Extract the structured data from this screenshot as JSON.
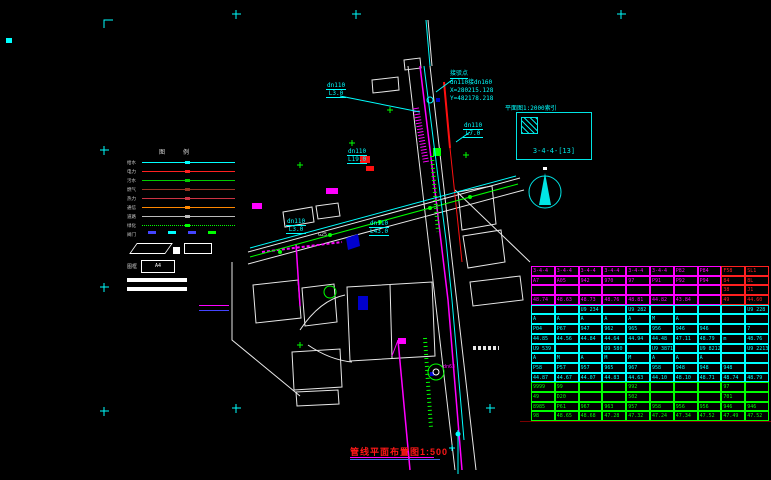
{
  "index_box": {
    "label": "平面图1:2000索引",
    "code": "3-4-4-[13]"
  },
  "connection_note": {
    "title": "接驳点",
    "pipe": "dn110接dn160",
    "x": "X=280215.128",
    "y": "Y=482178.218"
  },
  "pipe_labels": [
    {
      "d": "dn110",
      "l": "L3.0"
    },
    {
      "d": "dn110",
      "l": "L7.0"
    },
    {
      "d": "dn110",
      "l": "L19.0"
    },
    {
      "d": "dn110",
      "l": "L3.0"
    },
    {
      "d": "dn110",
      "l": "L43.0"
    }
  ],
  "misc": {
    "dn63": "dn63",
    "g_label": "G25"
  },
  "title": {
    "text": "管线平面布置图",
    "scale": "1:500"
  },
  "legend": {
    "headers": [
      "图",
      "例"
    ],
    "rows": [
      {
        "label": "给水",
        "color": "#00ffff",
        "style": "solid"
      },
      {
        "label": "电力",
        "color": "#ff2020",
        "style": "solid"
      },
      {
        "label": "污水",
        "color": "#00cc00",
        "style": "solid"
      },
      {
        "label": "燃气",
        "color": "#993322",
        "style": "solid"
      },
      {
        "label": "热力",
        "color": "#cc3344",
        "style": "solid"
      },
      {
        "label": "通信",
        "color": "#ff8800",
        "style": "solid"
      },
      {
        "label": "道路",
        "color": "#bbbbbb",
        "style": "solid"
      },
      {
        "label": "绿化",
        "color": "#00ff00",
        "style": "dotted"
      },
      {
        "label": "阀门",
        "color": "#4444ff",
        "style": "symbols"
      }
    ],
    "frame_label": "图框",
    "a4": "A4"
  },
  "table": {
    "groups": [
      {
        "color": "#ff00ff",
        "alt_color": "#ff2020",
        "alt_cols": [
          8,
          9
        ],
        "rows": [
          [
            "3-4-4",
            "3-4-4",
            "3-4-4",
            "3-4-4",
            "3-4-4",
            "3-4-4",
            "P82",
            "P84",
            "F58",
            "SL1"
          ],
          [
            "A7",
            "A05",
            "942",
            "970",
            "97",
            "P91",
            "P92",
            "P94",
            "84",
            "8L"
          ],
          [
            "",
            "",
            "",
            "",
            "",
            "",
            "",
            "",
            "38",
            "J1"
          ],
          [
            "48.74",
            "48.63",
            "48.73",
            "48.76",
            "48.81",
            "44.82",
            "43.84",
            "",
            "49",
            "44.60"
          ]
        ]
      },
      {
        "color": "#00ffff",
        "rows": [
          [
            "",
            "",
            "U9 234",
            "",
            "U9 282",
            "",
            "",
            "",
            "",
            "U9 228"
          ],
          [
            "A",
            "A",
            "A",
            "A",
            "A",
            "M",
            "A",
            "",
            "",
            ""
          ],
          [
            "P04",
            "P67",
            "947",
            "962",
            "965",
            "956",
            "946",
            "946",
            "",
            "7"
          ],
          [
            "44.85",
            "44.56",
            "44.84",
            "44.64",
            "44.94",
            "44.48",
            "47.11",
            "48.79",
            "m",
            "48.76"
          ]
        ]
      },
      {
        "color": "#00ffff",
        "rows": [
          [
            "U9 539",
            "",
            "",
            "U9 580",
            "",
            "U9 3871",
            "",
            "U9 8212",
            "",
            "U9 2213"
          ],
          [
            "A",
            "M",
            "A",
            "M",
            "M",
            "A",
            "A",
            "A",
            "",
            ""
          ],
          [
            "P58",
            "P57",
            "957",
            "965",
            "967",
            "958",
            "948",
            "948",
            "948",
            ""
          ],
          [
            "44.87",
            "44.67",
            "44.07",
            "44.83",
            "44.63",
            "44.10",
            "48.10",
            "48.71",
            "48.74",
            "48.79"
          ]
        ]
      },
      {
        "color": "#00ff00",
        "rows": [
          [
            "9999",
            "99",
            "",
            "",
            "992",
            "",
            "",
            "",
            "97",
            ""
          ],
          [
            "49",
            "D20",
            "",
            "",
            "502",
            "",
            "",
            "",
            "701",
            ""
          ],
          [
            "8985",
            "P61",
            "967",
            "963",
            "957",
            "958",
            "956",
            "956",
            "946",
            "946"
          ],
          [
            "98",
            "48.65",
            "48.68",
            "47.28",
            "47.32",
            "47.24",
            "47.34",
            "47.52",
            "47.49",
            "47.52"
          ]
        ]
      }
    ]
  }
}
